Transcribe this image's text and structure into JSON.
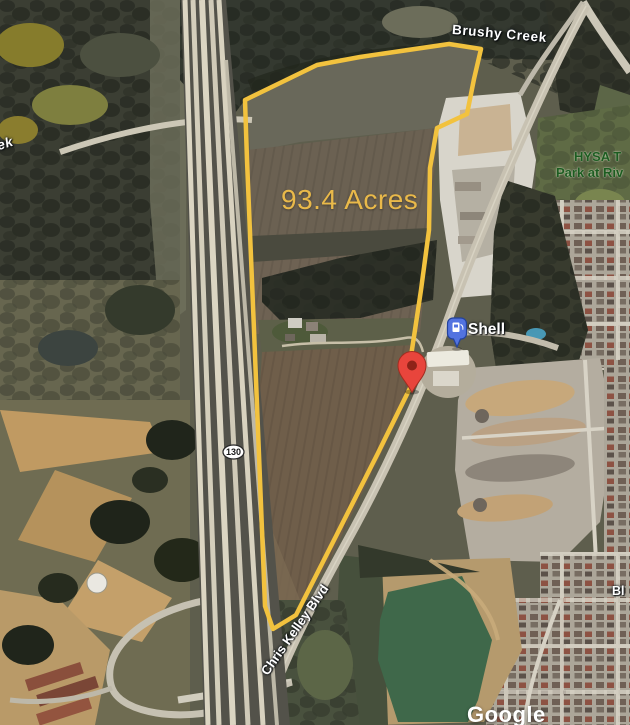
{
  "map": {
    "type": "satellite-aerial-view",
    "parcel": {
      "acreage_label": "93.4 Acres"
    },
    "labels": {
      "creek_partial": "ek",
      "brushy_creek": "Brushy Creek",
      "park_name_line1": "HYSA T",
      "park_name_line2": "Park at Riv",
      "street": "Chris Kelley Blvd",
      "street_partial": "Bl",
      "highway_shield": "130"
    },
    "poi": {
      "gas_station": "Shell"
    },
    "markers": {
      "gas_pin": "fuel-pump-pin",
      "property_pin": "red-location-pin"
    },
    "attribution": "Google",
    "colors": {
      "parcel_outline": "#F2C23E",
      "acreage_text": "#E9B94A",
      "park_text": "#1D5C21",
      "red_pin": "#E8453C",
      "gas_pin": "#5273E0"
    }
  }
}
